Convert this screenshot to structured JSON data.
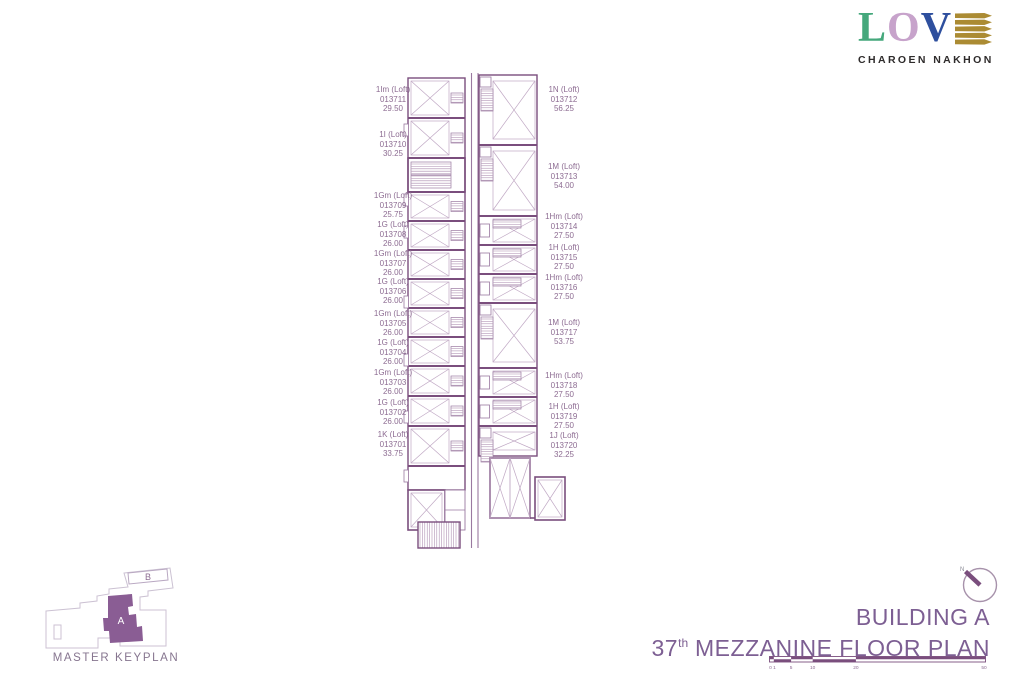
{
  "logo": {
    "letter1": "L",
    "letter2": "O",
    "letter3": "V",
    "emark_icon": "stacked-gold-leaves-e",
    "subtitle": "CHAROEN NAKHON"
  },
  "units": {
    "left": [
      {
        "name": "1Im (Loft)",
        "no": "013711",
        "area": "29.50"
      },
      {
        "name": "1I (Loft)",
        "no": "013710",
        "area": "30.25"
      },
      {
        "name": "1Gm (Loft)",
        "no": "013709",
        "area": "25.75"
      },
      {
        "name": "1G (Loft)",
        "no": "013708",
        "area": "26.00"
      },
      {
        "name": "1Gm (Loft)",
        "no": "013707",
        "area": "26.00"
      },
      {
        "name": "1G (Loft)",
        "no": "013706",
        "area": "26.00"
      },
      {
        "name": "1Gm (Loft)",
        "no": "013705",
        "area": "26.00"
      },
      {
        "name": "1G (Loft)",
        "no": "013704",
        "area": "26.00"
      },
      {
        "name": "1Gm (Loft)",
        "no": "013703",
        "area": "26.00"
      },
      {
        "name": "1G (Loft)",
        "no": "013702",
        "area": "26.00"
      },
      {
        "name": "1K (Loft)",
        "no": "013701",
        "area": "33.75"
      }
    ],
    "right": [
      {
        "name": "1N (Loft)",
        "no": "013712",
        "area": "56.25"
      },
      {
        "name": "1M (Loft)",
        "no": "013713",
        "area": "54.00"
      },
      {
        "name": "1Hm (Loft)",
        "no": "013714",
        "area": "27.50"
      },
      {
        "name": "1H (Loft)",
        "no": "013715",
        "area": "27.50"
      },
      {
        "name": "1Hm (Loft)",
        "no": "013716",
        "area": "27.50"
      },
      {
        "name": "1M (Loft)",
        "no": "013717",
        "area": "53.75"
      },
      {
        "name": "1Hm (Loft)",
        "no": "013718",
        "area": "27.50"
      },
      {
        "name": "1H (Loft)",
        "no": "013719",
        "area": "27.50"
      },
      {
        "name": "1J (Loft)",
        "no": "013720",
        "area": "32.25"
      }
    ]
  },
  "keyplan": {
    "caption": "MASTER KEYPLAN",
    "building_a_label": "A",
    "building_b_label": "B"
  },
  "titleblock": {
    "line1": "BUILDING A",
    "floor_number": "37",
    "floor_suffix": "th",
    "line2_rest": " MEZZANINE FLOOR PLAN"
  },
  "compass": {
    "north_label": "N"
  },
  "scalebar": {
    "marks": [
      "0",
      "1",
      "5",
      "10",
      "20",
      "50"
    ]
  },
  "colors": {
    "plan_wall": "#7a4e7d",
    "label_text": "#8d6c92",
    "title_text": "#7d5f93",
    "logo_green": "#45a87c",
    "logo_lilac": "#c7a3cb",
    "logo_blue": "#2e4f9e",
    "logo_gold": "#ab8b33"
  }
}
